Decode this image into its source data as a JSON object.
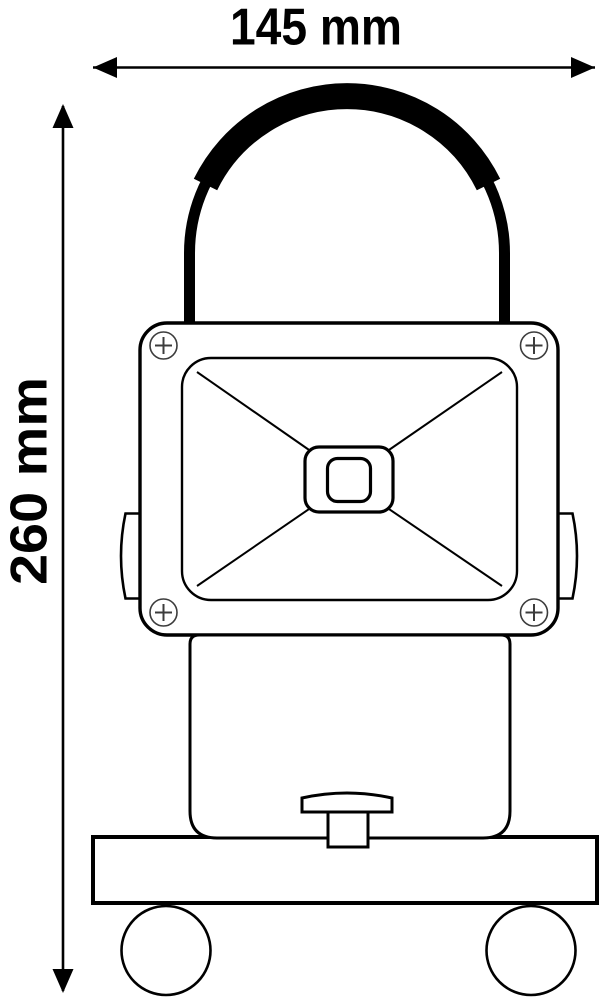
{
  "figure": {
    "width_dimension_label": "145 mm",
    "height_dimension_label": "260 mm",
    "colors": {
      "line": "#000000",
      "background": "#ffffff",
      "screw": "#3c3c3c"
    }
  }
}
